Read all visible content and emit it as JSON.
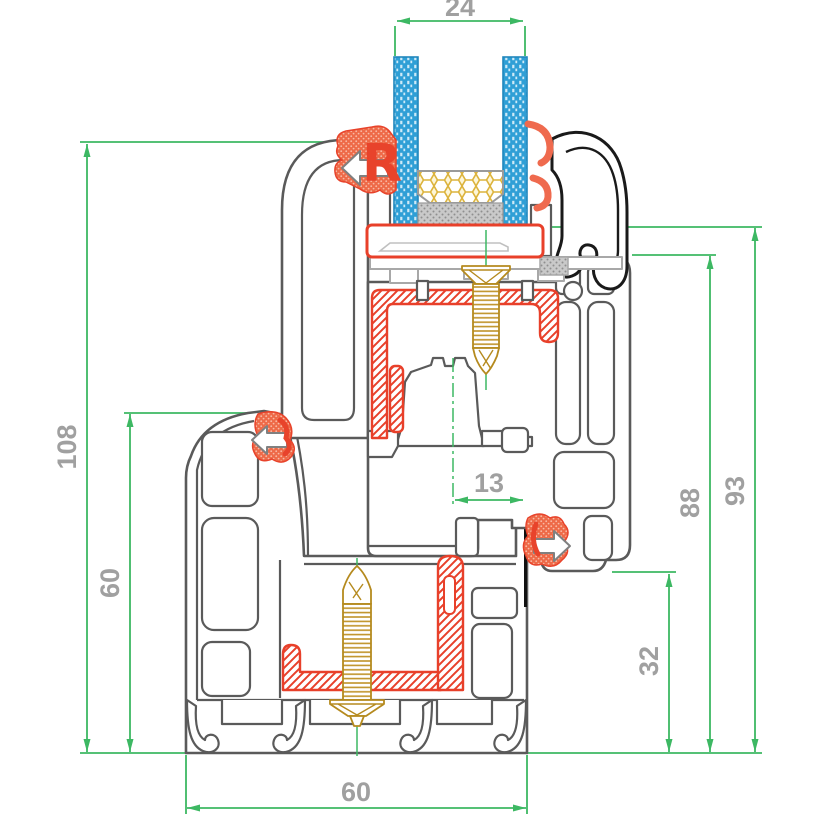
{
  "drawing": {
    "type": "pvc-window-frame-cross-section",
    "dims": {
      "top": "24",
      "left_outer": "108",
      "left_inner": "60",
      "middle": "13",
      "right_inner": "88",
      "right_outer": "93",
      "right_lower": "32",
      "bottom": "60"
    },
    "gasket_cavity_glyph": "R",
    "colors": {
      "dimension_line": "#3db863",
      "dimension_text": "#a0a0a0",
      "profile_outline": "#5a5a5a",
      "fin_outline": "#1a1a1a",
      "gasket_red": "#e8432b",
      "steel_reinforcement_red": "#e8402a",
      "glass_blue": "#2f9fd6",
      "screw_gold": "#b58a1e",
      "spacer_honeycomb_yellow": "#dcb33c"
    }
  }
}
